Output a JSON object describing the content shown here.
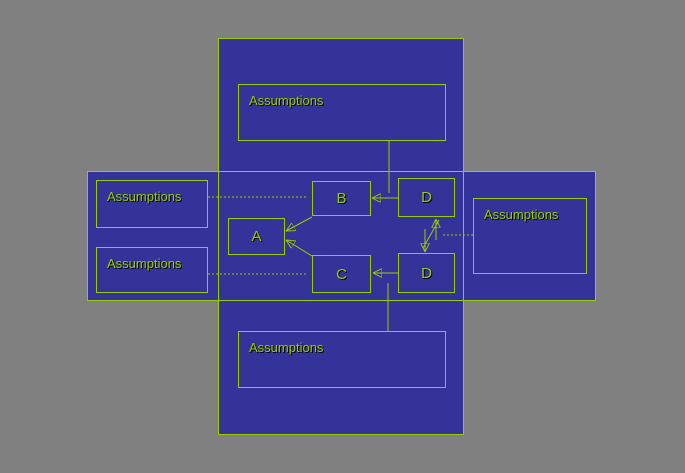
{
  "colors": {
    "background": "#808080",
    "panel_fill": "#333399",
    "outline": "#99CC00",
    "label_text": "#99CC00",
    "label_shadow": "#000000"
  },
  "annotations": {
    "top": {
      "label": "Assumptions"
    },
    "left_upper": {
      "label": "Assumptions"
    },
    "left_lower": {
      "label": "Assumptions"
    },
    "right": {
      "label": "Assumptions"
    },
    "bottom": {
      "label": "Assumptions"
    }
  },
  "nodes": {
    "a": {
      "label": "A"
    },
    "b": {
      "label": "B"
    },
    "c": {
      "label": "C"
    },
    "d_upper": {
      "label": "D"
    },
    "d_lower": {
      "label": "D"
    }
  },
  "connectors": [
    "d-upper-to-b-arrow",
    "d-lower-to-c-arrow",
    "b-to-a-arrow",
    "c-to-a-arrow",
    "d-upper-d-lower-double-arrow",
    "top-assumptions-line",
    "bottom-assumptions-line",
    "left-upper-assumptions-dotted-line",
    "left-lower-assumptions-dotted-line",
    "right-assumptions-dotted-line"
  ]
}
